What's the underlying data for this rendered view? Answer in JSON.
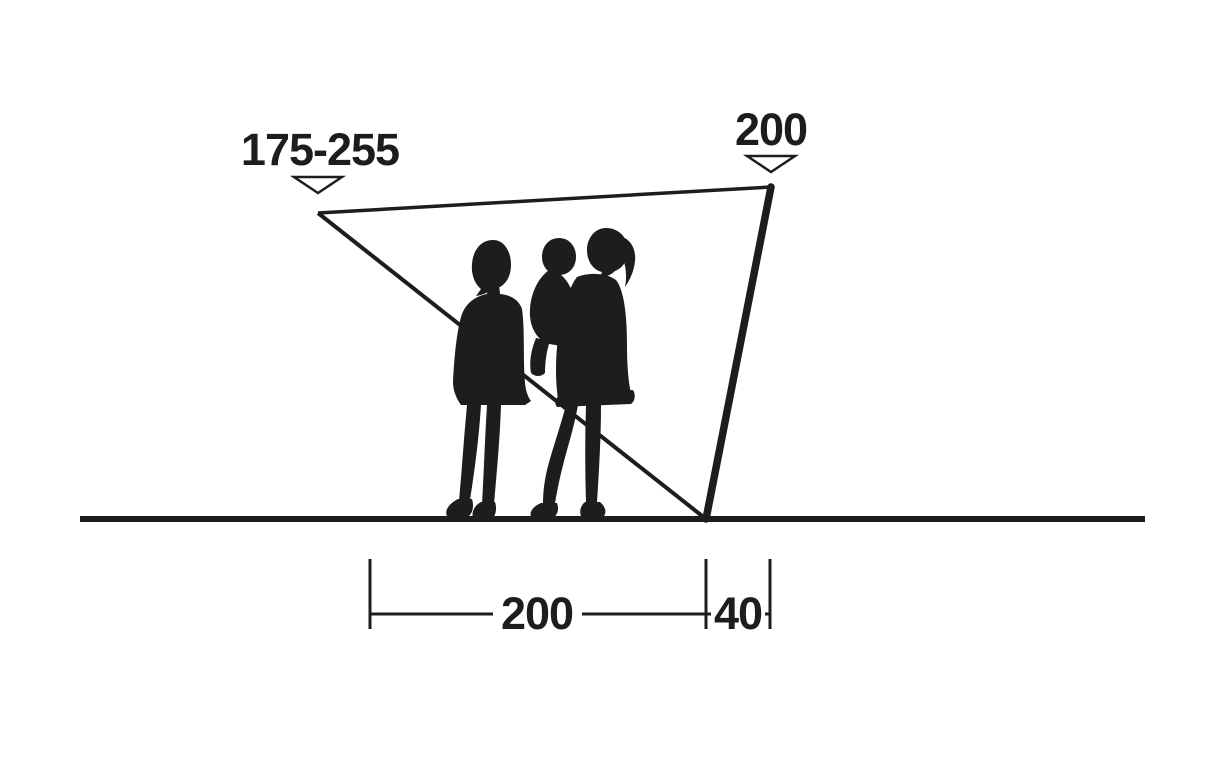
{
  "colors": {
    "ink": "#1d1d1b",
    "background": "#ffffff"
  },
  "labels": {
    "front_height": "175-255",
    "pole_height": "200",
    "depth": "200",
    "pole_offset": "40"
  },
  "icons": {
    "down_arrow": "open triangle pointing down (▽)"
  }
}
